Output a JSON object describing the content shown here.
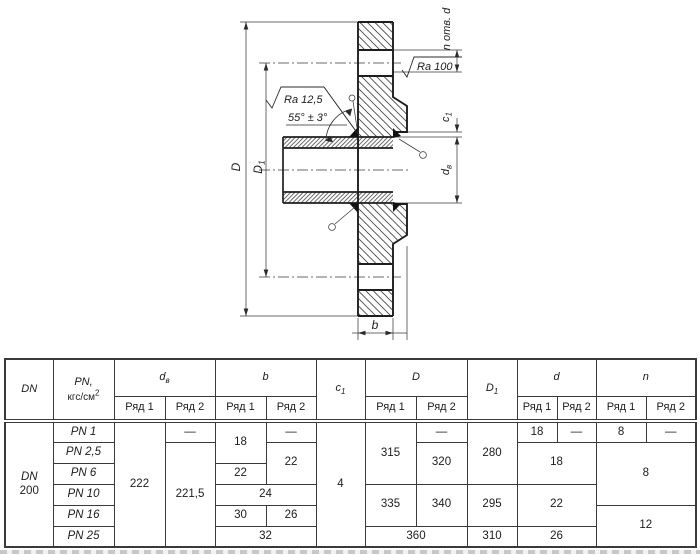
{
  "drawing": {
    "labels": {
      "n_otv_d": "n отв. d",
      "ra_100": "Ra 100",
      "ra_125": "Ra 12,5",
      "angle": "55° ± 3°",
      "D": "D",
      "D1_main": "D",
      "D1_sub": "1",
      "c1_main": "c",
      "c1_sub": "1",
      "dv_main": "d",
      "dv_sub": "в",
      "b": "b"
    }
  },
  "table": {
    "headers": {
      "dn": "DN",
      "pn_line1": "PN,",
      "pn_unit": "кгс/см",
      "pn_sup": "2",
      "dv_main": "d",
      "dv_sub": "в",
      "b": "b",
      "c1_main": "c",
      "c1_sub": "1",
      "D": "D",
      "D1_main": "D",
      "D1_sub": "1",
      "d": "d",
      "n": "n",
      "ryad1": "Ряд 1",
      "ryad2": "Ряд 2"
    },
    "body": {
      "dn_line1": "DN",
      "dn_line2": "200",
      "pn": [
        "PN 1",
        "PN 2,5",
        "PN 6",
        "PN 10",
        "PN 16",
        "PN 25"
      ],
      "dv_ryad1": "222",
      "dv_ryad2_pn1": "—",
      "dv_ryad2": "221,5",
      "b_ryad1_pn1_2_5": "18",
      "b_ryad2_pn1": "—",
      "b_ryad2_pn2_5_6": "22",
      "b_ryad1_pn6": "22",
      "b_pn10": "24",
      "b_ryad1_pn16": "30",
      "b_ryad2_pn16": "26",
      "b_pn25": "32",
      "c1": "4",
      "D_ryad1_pn1_6": "315",
      "D_ryad2_pn1": "—",
      "D_ryad2_pn2_5_6": "320",
      "D_ryad1_pn10_16": "335",
      "D_ryad2_pn10_16": "340",
      "D_pn25": "360",
      "D1_pn1_6": "280",
      "D1_pn10_16": "295",
      "D1_pn25": "310",
      "d_ryad1_pn1": "18",
      "d_ryad2_pn1": "—",
      "d_pn2_5_6": "18",
      "d_pn10_16": "22",
      "d_pn25": "26",
      "n_ryad1_pn1": "8",
      "n_ryad2_pn1": "—",
      "n_pn2_5_10": "8",
      "n_pn16_25": "12"
    }
  }
}
